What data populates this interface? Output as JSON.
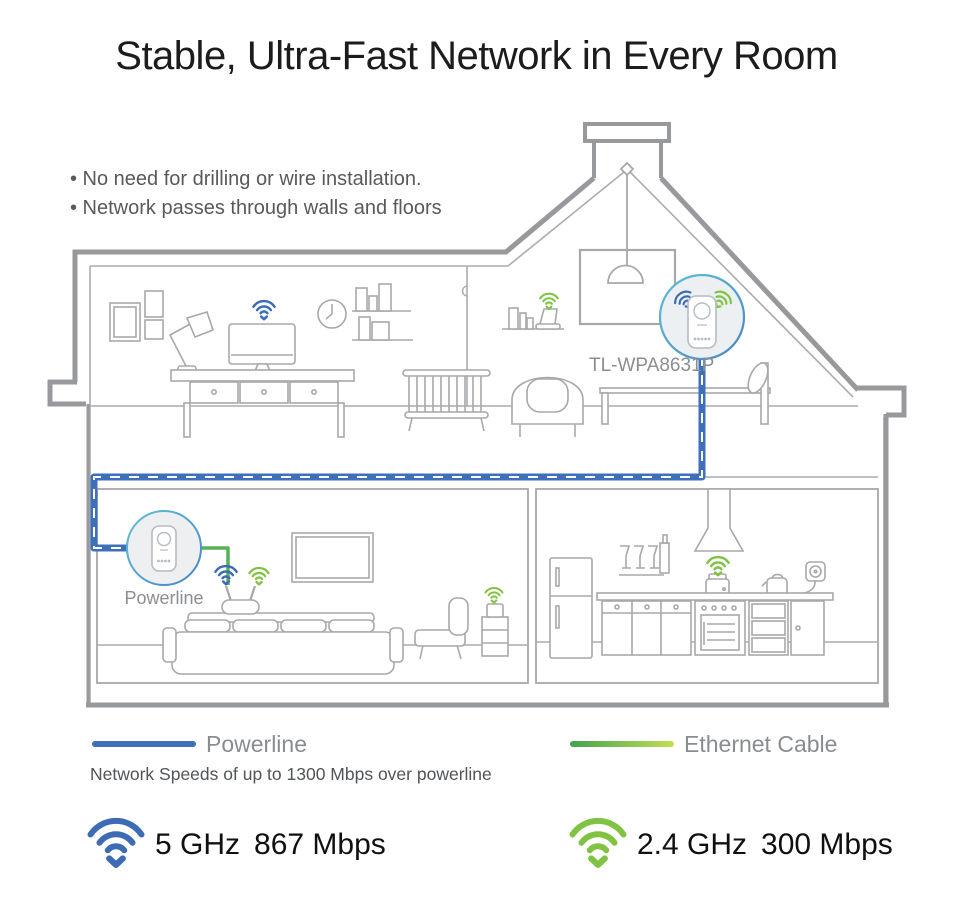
{
  "title": "Stable, Ultra-Fast Network in Every Room",
  "bullets": {
    "items": [
      "• No need for drilling or wire installation.",
      "• Network passes through walls and floors"
    ]
  },
  "diagram": {
    "adapter_top_label": "TL-WPA8631P",
    "adapter_bottom_label": "Powerline",
    "icons": {
      "wifi_blue": "wifi-icon",
      "wifi_green": "wifi-icon",
      "powerline_adapter": "powerline-adapter-device"
    }
  },
  "legend": {
    "powerline_label": "Powerline",
    "ethernet_label": "Ethernet Cable",
    "note": "Network Speeds of up to 1300 Mbps over powerline"
  },
  "speeds": {
    "band5": {
      "freq": "5 GHz",
      "rate": "867 Mbps"
    },
    "band24": {
      "freq": "2.4 GHz",
      "rate": "300 Mbps"
    }
  },
  "colors": {
    "powerline_blue": "#3e6fba",
    "wifi_blue": "#3d6cb4",
    "wifi_green": "#80c342",
    "ethernet_gradient_start": "#44a24c",
    "ethernet_gradient_end": "#c3dd55",
    "outline_gray": "#97999c",
    "furniture_gray": "#a6a8aa",
    "label_gray": "#8b8e91",
    "circle_ring": "#54a3cf"
  }
}
